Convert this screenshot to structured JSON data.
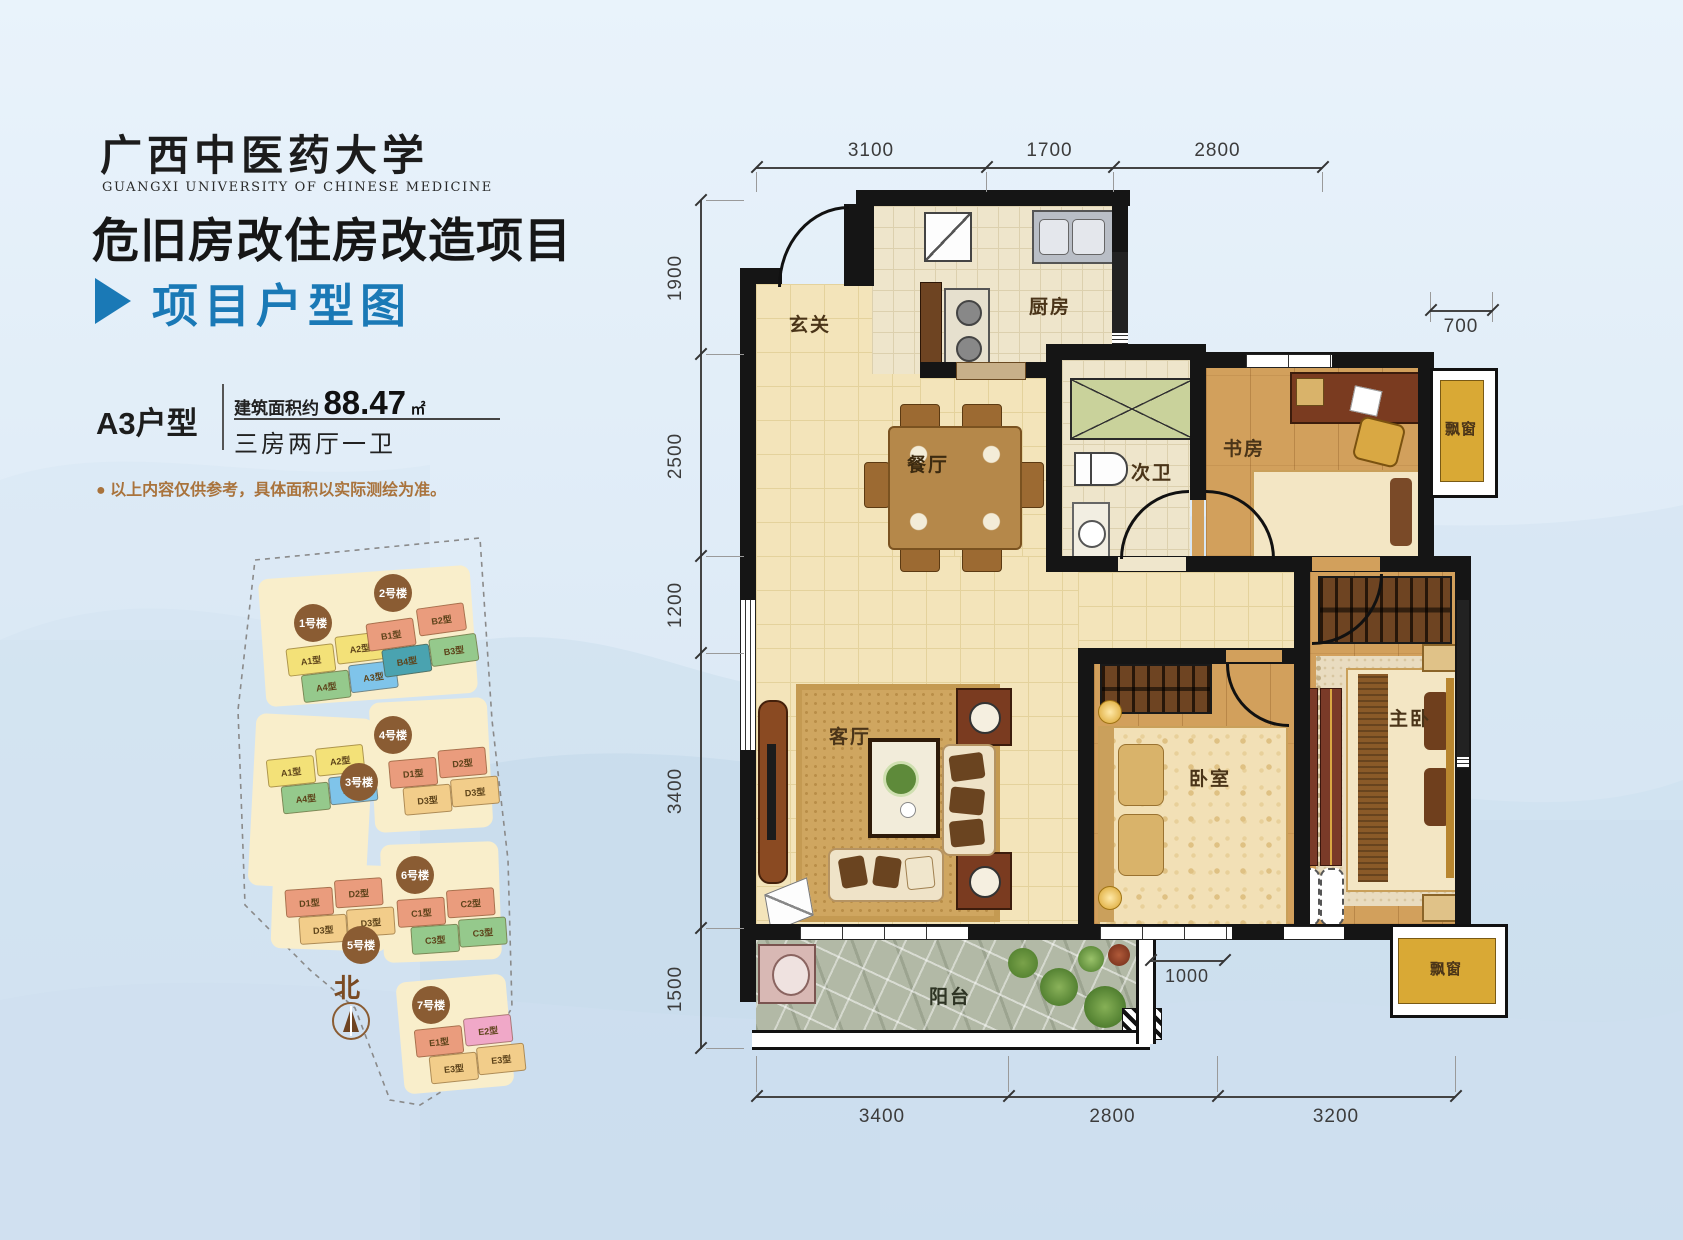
{
  "header": {
    "university_cn": "广西中医药大学",
    "university_en": "GUANGXI UNIVERSITY OF CHINESE MEDICINE",
    "project_title": "危旧房改住房改造项目",
    "section_title": "项目户型图"
  },
  "unit_info": {
    "unit_name": "A3户型",
    "area_prefix": "建筑面积约",
    "area_value": "88.47",
    "area_unit": "㎡",
    "layout": "三房两厅一卫",
    "disclaimer": "● 以上内容仅供参考，具体面积以实际测绘为准。"
  },
  "sitemap": {
    "north_label": "北",
    "buildings": [
      {
        "name": "1号楼",
        "units": [
          {
            "label": "A1型",
            "color": "#f3e178"
          },
          {
            "label": "A2型",
            "color": "#f3e178"
          },
          {
            "label": "A4型",
            "color": "#95c98c"
          },
          {
            "label": "A3型",
            "color": "#7fc4ea"
          }
        ]
      },
      {
        "name": "2号楼",
        "units": [
          {
            "label": "B1型",
            "color": "#ea9c7d"
          },
          {
            "label": "B2型",
            "color": "#ea9c7d"
          },
          {
            "label": "B4型",
            "color": "#4aa3b0"
          },
          {
            "label": "B3型",
            "color": "#95c98c"
          }
        ]
      },
      {
        "name": "3号楼",
        "units": [
          {
            "label": "A1型",
            "color": "#f3e178"
          },
          {
            "label": "A2型",
            "color": "#f3e178"
          },
          {
            "label": "A4型",
            "color": "#95c98c"
          },
          {
            "label": "A3型",
            "color": "#7fc4ea"
          }
        ]
      },
      {
        "name": "4号楼",
        "units": [
          {
            "label": "D1型",
            "color": "#ea9c7d"
          },
          {
            "label": "D2型",
            "color": "#ea9c7d"
          },
          {
            "label": "D3型",
            "color": "#f2cd8a"
          },
          {
            "label": "D3型",
            "color": "#f2cd8a"
          }
        ]
      },
      {
        "name": "5号楼",
        "units": [
          {
            "label": "D1型",
            "color": "#ea9c7d"
          },
          {
            "label": "D2型",
            "color": "#ea9c7d"
          },
          {
            "label": "D3型",
            "color": "#f2cd8a"
          },
          {
            "label": "D3型",
            "color": "#f2cd8a"
          }
        ]
      },
      {
        "name": "6号楼",
        "units": [
          {
            "label": "C1型",
            "color": "#ea9c7d"
          },
          {
            "label": "C2型",
            "color": "#ea9c7d"
          },
          {
            "label": "C3型",
            "color": "#95c98c"
          },
          {
            "label": "C3型",
            "color": "#95c98c"
          }
        ]
      },
      {
        "name": "7号楼",
        "units": [
          {
            "label": "E1型",
            "color": "#ea9c7d"
          },
          {
            "label": "E2型",
            "color": "#f0a8c8"
          },
          {
            "label": "E3型",
            "color": "#f2cd8a"
          },
          {
            "label": "E3型",
            "color": "#f2cd8a"
          }
        ]
      }
    ]
  },
  "floorplan": {
    "rooms": {
      "entry": "玄关",
      "kitchen": "厨房",
      "dining": "餐厅",
      "bath": "次卫",
      "study": "书房",
      "living": "客厅",
      "bedroom": "卧室",
      "master": "主卧",
      "balcony": "阳台",
      "bay_top": "飘窗",
      "bay_bottom": "飘窗"
    },
    "dims": {
      "top": [
        "3100",
        "1700",
        "2800"
      ],
      "left": [
        "1900",
        "2500",
        "1200",
        "3400",
        "1500"
      ],
      "bottom": [
        "3400",
        "2800",
        "3200"
      ],
      "bay": "700",
      "balcony": "1000"
    }
  },
  "colors": {
    "accent_blue": "#1a79b6",
    "wall_black": "#151515",
    "bay_gold": "#d9a935",
    "disclaimer_brown": "#a9733c",
    "badge_brown": "#8a5c33"
  }
}
